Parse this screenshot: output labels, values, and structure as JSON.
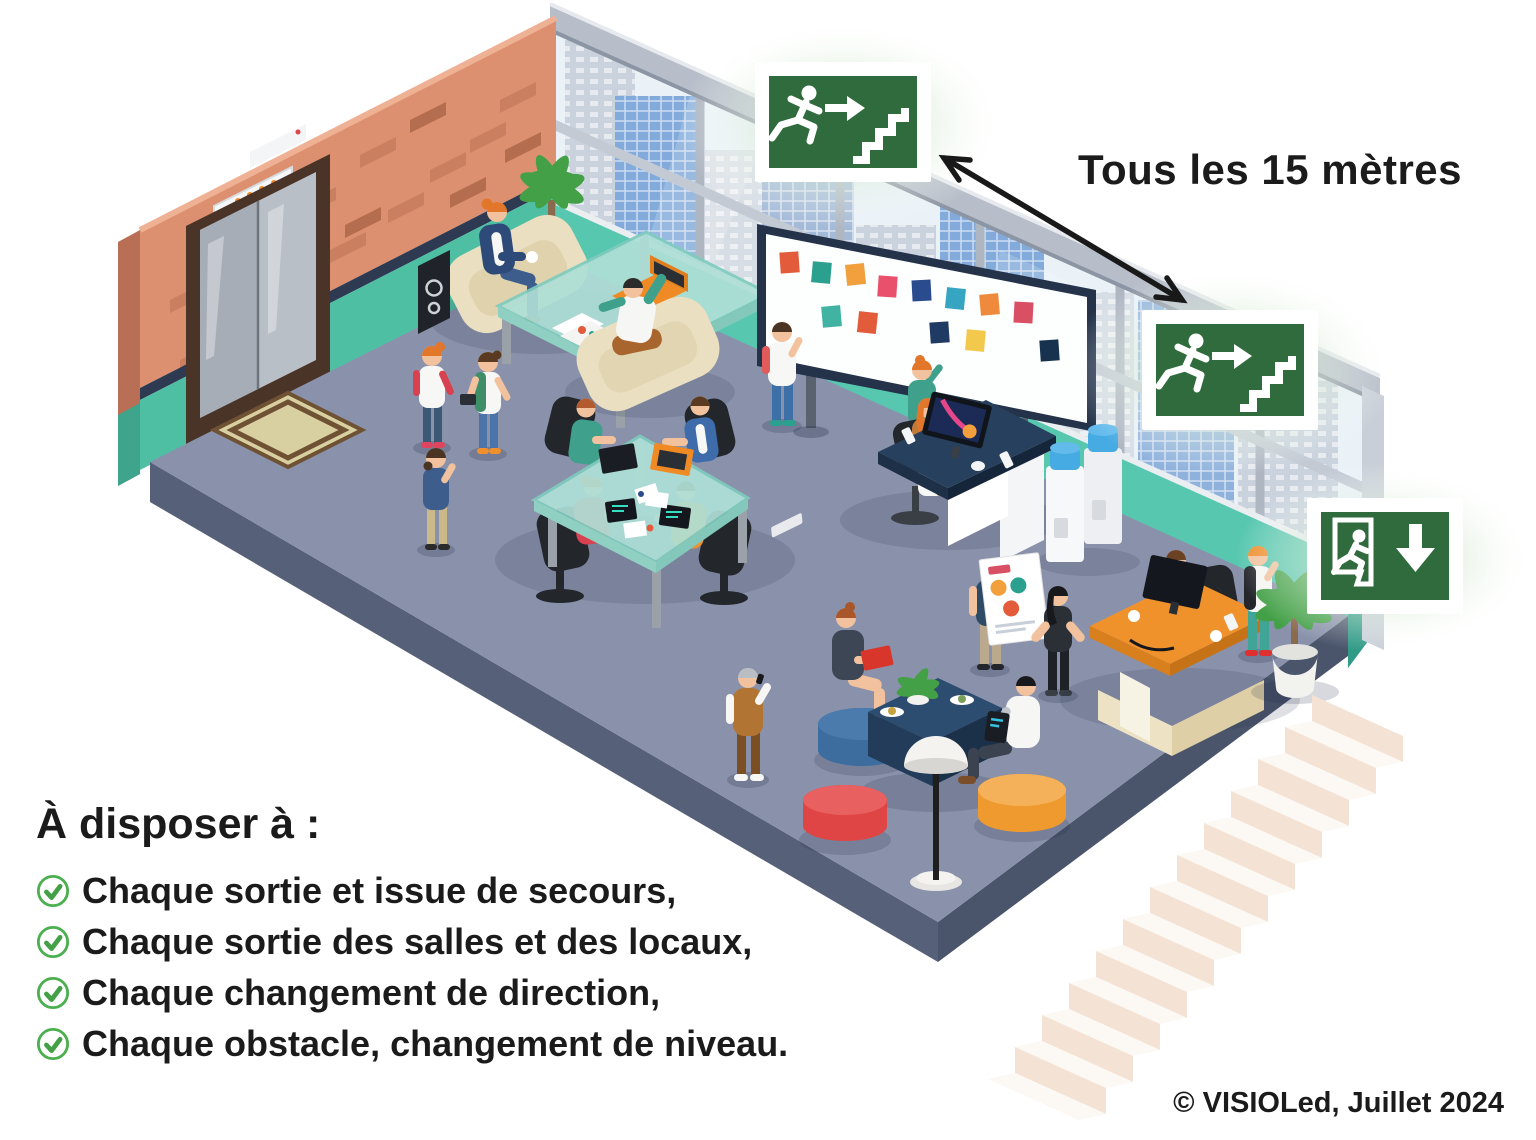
{
  "annotation": {
    "interval_text": "Tous les 15 mètres"
  },
  "legend": {
    "heading": "À disposer à :",
    "items": [
      "Chaque sortie et issue de secours,",
      "Chaque sortie des salles et des locaux,",
      "Chaque changement de direction,",
      "Chaque obstacle, changement de niveau."
    ]
  },
  "footer": {
    "copyright": "© VISIOLed, Juillet 2024"
  },
  "signs": {
    "top": {
      "icon": "exit-sign-running-man-stairs-icon",
      "panel_color": "#2F6B3C"
    },
    "middle": {
      "icon": "exit-sign-running-man-stairs-icon",
      "panel_color": "#2F6B3C"
    },
    "bottom": {
      "icon": "exit-sign-running-man-door-down-arrow-icon",
      "panel_color": "#2F6B3C"
    }
  },
  "icons": {
    "bullet": "circle-check-icon",
    "spacing": "double-headed-arrow-icon"
  },
  "colors": {
    "sign_green": "#2F6B3C",
    "check_green": "#4CAF50",
    "text": "#1b1b1b",
    "brick_wall": "#DC9070",
    "teal_wall": "#54C5AE",
    "floor": "#8A92AB",
    "floor_side": "#566078",
    "stairs": "#F4E3D4",
    "arrow": "#191919"
  }
}
